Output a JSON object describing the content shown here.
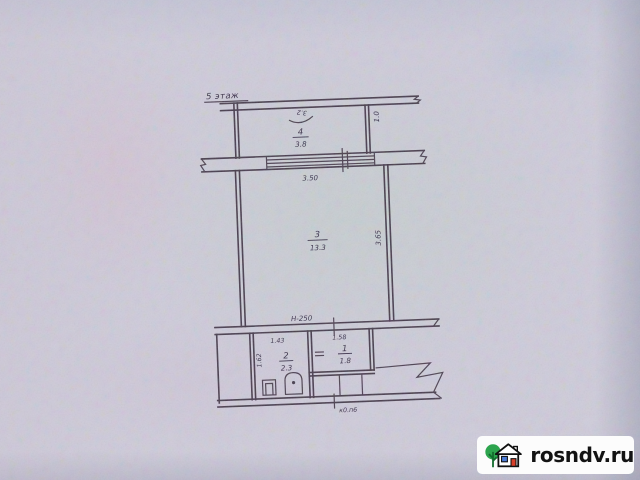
{
  "plan": {
    "floor_label": "5 этаж",
    "rooms": [
      {
        "id": "balcony",
        "number": "4",
        "area": "3.8"
      },
      {
        "id": "living",
        "number": "3",
        "area": "13.3"
      },
      {
        "id": "bath",
        "number": "2",
        "area": "2.3"
      },
      {
        "id": "wc",
        "number": "1",
        "area": "1.8"
      }
    ],
    "dims": {
      "balcony_door": "3.2",
      "balcony_depth": "1.0",
      "window_width": "3.50",
      "room_depth": "3.65",
      "wall_mark": "Н-250",
      "bath_width": "1.43",
      "bath_depth": "1.62",
      "wc_width": "1.58",
      "bottom_note": "к0.п6"
    }
  },
  "watermark": {
    "text": "rosndv.ru",
    "icons": [
      "tree-icon",
      "house-icon"
    ]
  },
  "colors": {
    "paper": "#cfccdb",
    "ink": "#463b4c",
    "logo_green": "#2da44e",
    "logo_blue": "#4b7bd6",
    "logo_red": "#d8402a"
  }
}
